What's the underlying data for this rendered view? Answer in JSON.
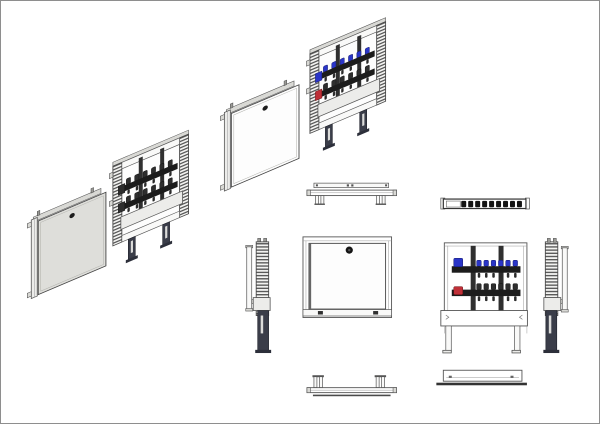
{
  "page": {
    "background": "#ffffff",
    "border_color": "#8e8e8e"
  },
  "drawing": {
    "type": "technical-drawing",
    "subject": "manifold cabinet assembly",
    "colors": {
      "valve-blue": "#2a35c8",
      "valve-red": "#bf3038",
      "valve-dark": "#141414",
      "door-gray": "#dededa",
      "frame-light": "#ececea",
      "line-dark": "#4a4a4a",
      "leg-dark": "#3a3d49"
    },
    "manifold": {
      "rows": 2,
      "loops": 6
    },
    "views": [
      {
        "id": "iso-door-gray",
        "kind": "isometric",
        "label": "cabinet door (shaded)"
      },
      {
        "id": "iso-frame-plain",
        "kind": "isometric",
        "label": "manifold frame"
      },
      {
        "id": "iso-door-white",
        "kind": "isometric",
        "label": "cabinet door"
      },
      {
        "id": "iso-frame-valves",
        "kind": "isometric",
        "label": "manifold frame with valves"
      },
      {
        "id": "top-view-cabinet",
        "kind": "orthographic",
        "label": "top view - cabinet"
      },
      {
        "id": "top-view-manifold",
        "kind": "orthographic",
        "label": "top view - manifold"
      },
      {
        "id": "side-view-left",
        "kind": "orthographic",
        "label": "side view - left"
      },
      {
        "id": "front-view-closed",
        "kind": "orthographic",
        "label": "front view - door closed"
      },
      {
        "id": "front-view-open",
        "kind": "orthographic",
        "label": "front view - manifold"
      },
      {
        "id": "side-view-right",
        "kind": "orthographic",
        "label": "side view - right"
      },
      {
        "id": "bottom-view-cabinet",
        "kind": "orthographic",
        "label": "bottom view - cabinet"
      },
      {
        "id": "bottom-view-manifold",
        "kind": "orthographic",
        "label": "bottom view - frame"
      }
    ]
  }
}
